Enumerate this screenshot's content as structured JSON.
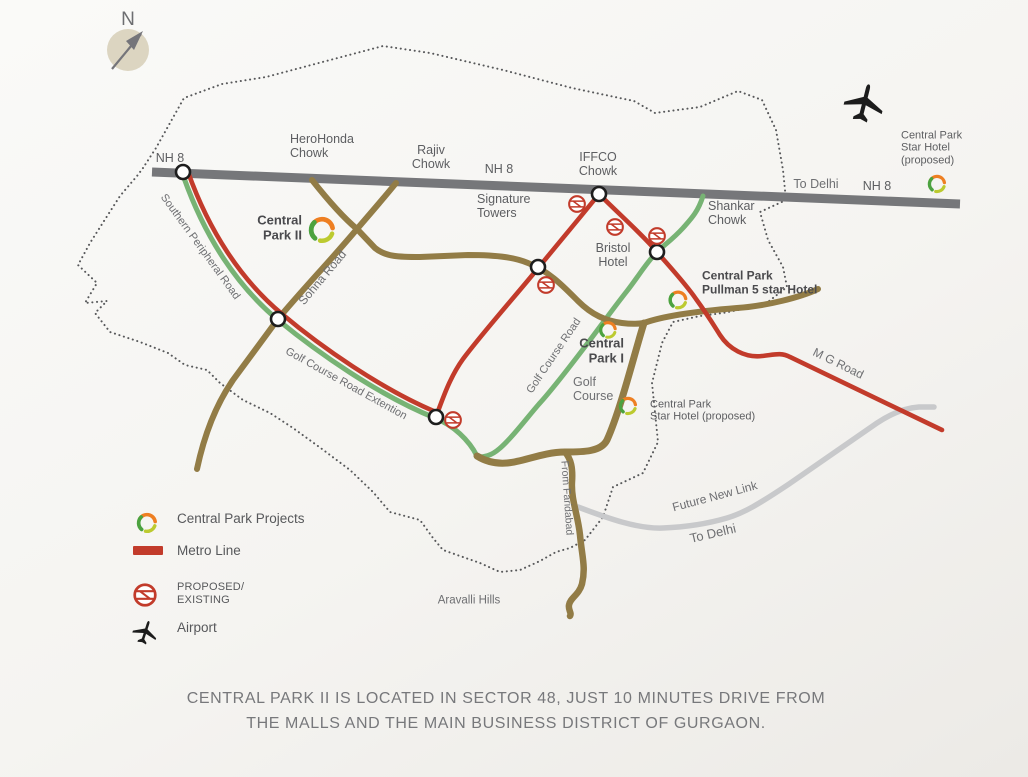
{
  "title": "Central Park II location map, Gurgaon",
  "compass": {
    "label": "N"
  },
  "colors": {
    "nh8_road": "#76777a",
    "brown_road": "#927c46",
    "green_road": "#77b374",
    "metro_red": "#c23b2b",
    "future_link_gray": "#c8c9cb",
    "boundary_dots": "#57585a",
    "label_text": "#5d5e61",
    "road_text": "#6e6f72",
    "caption_text": "#77787b",
    "logo_orange": "#ee7f22",
    "logo_green": "#4ca23f",
    "logo_lime": "#bcca2f",
    "compass_fill": "#dcd5c1"
  },
  "map": {
    "labels": [
      {
        "id": "nh8-left",
        "text": "NH 8",
        "x": 170,
        "y": 158,
        "ha": "center",
        "size": 12.5
      },
      {
        "id": "herohonda-chowk",
        "text": "HeroHonda\nChowk",
        "x": 290,
        "y": 146,
        "ha": "left",
        "size": 12.5
      },
      {
        "id": "rajiv-chowk",
        "text": "Rajiv\nChowk",
        "x": 431,
        "y": 157,
        "ha": "center",
        "size": 12.5
      },
      {
        "id": "nh8-center",
        "text": "NH 8",
        "x": 499,
        "y": 169,
        "ha": "center",
        "size": 12.5
      },
      {
        "id": "iffco-chowk",
        "text": "IFFCO\nChowk",
        "x": 598,
        "y": 164,
        "ha": "center",
        "size": 12.5
      },
      {
        "id": "signature-towers",
        "text": "Signature\nTowers",
        "x": 477,
        "y": 206,
        "ha": "left",
        "size": 12.5
      },
      {
        "id": "shankar-chowk",
        "text": "Shankar\nChowk",
        "x": 708,
        "y": 213,
        "ha": "left",
        "size": 12.5
      },
      {
        "id": "to-delhi-top",
        "text": "To Delhi",
        "x": 816,
        "y": 184,
        "ha": "center",
        "size": 12.5,
        "color": "#6e6f72"
      },
      {
        "id": "nh8-right",
        "text": "NH 8",
        "x": 877,
        "y": 186,
        "ha": "center",
        "size": 12.5
      },
      {
        "id": "cp-star-hotel-ne",
        "text": "Central Park\nStar Hotel\n(proposed)",
        "x": 901,
        "y": 148,
        "ha": "left",
        "size": 11
      },
      {
        "id": "central-park-2",
        "text": "Central\nPark II",
        "x": 302,
        "y": 228,
        "ha": "right",
        "size": 13,
        "bold": true,
        "color": "#4a4a4d"
      },
      {
        "id": "bristol-hotel",
        "text": "Bristol\nHotel",
        "x": 613,
        "y": 255,
        "ha": "center",
        "size": 12.5
      },
      {
        "id": "cp-pullman",
        "text": "Central Park\nPullman 5 star Hotel",
        "x": 702,
        "y": 283,
        "ha": "left",
        "size": 12,
        "bold": true,
        "color": "#4a4a4d"
      },
      {
        "id": "central-park-1",
        "text": "Central\nPark I",
        "x": 624,
        "y": 351,
        "ha": "right",
        "size": 13,
        "bold": true,
        "color": "#4a4a4d"
      },
      {
        "id": "golf-course",
        "text": "Golf\nCourse",
        "x": 573,
        "y": 389,
        "ha": "left",
        "size": 12.5,
        "color": "#6e6f72"
      },
      {
        "id": "cp-star-hotel-mid",
        "text": "Central Park\nStar Hotel (proposed)",
        "x": 650,
        "y": 411,
        "ha": "left",
        "size": 11
      },
      {
        "id": "aravalli-hills",
        "text": "Aravalli Hills",
        "x": 469,
        "y": 601,
        "ha": "center",
        "size": 11.5,
        "color": "#6e6f72"
      },
      {
        "id": "southern-peripheral-road",
        "text": "Southern Peripheral Road",
        "x": 200,
        "y": 247,
        "ha": "center",
        "rot": 54,
        "size": 11,
        "color": "#6e6f72"
      },
      {
        "id": "sohna-road",
        "text": "Sohna Road",
        "x": 323,
        "y": 278,
        "ha": "center",
        "rot": -50,
        "size": 12,
        "color": "#6e6f72"
      },
      {
        "id": "golf-course-road-extention",
        "text": "Golf Course Road Extention",
        "x": 346,
        "y": 384,
        "ha": "center",
        "rot": 29,
        "size": 11,
        "color": "#6e6f72"
      },
      {
        "id": "golf-course-road",
        "text": "Golf Course Road",
        "x": 554,
        "y": 356,
        "ha": "center",
        "rot": -56,
        "size": 11,
        "color": "#6e6f72"
      },
      {
        "id": "from-faridabad",
        "text": "From Faridabad",
        "x": 566,
        "y": 498,
        "ha": "center",
        "rot": 86,
        "size": 10.5,
        "color": "#6e6f72"
      },
      {
        "id": "mg-road",
        "text": "M G Road",
        "x": 838,
        "y": 364,
        "ha": "center",
        "rot": 26,
        "size": 12,
        "color": "#6e6f72"
      },
      {
        "id": "future-new-link",
        "text": "Future New Link",
        "x": 715,
        "y": 497,
        "ha": "center",
        "rot": -15,
        "size": 12,
        "color": "#6e6f72"
      },
      {
        "id": "to-delhi-se",
        "text": "To Delhi",
        "x": 713,
        "y": 534,
        "ha": "center",
        "rot": -13,
        "size": 13,
        "color": "#6e6f72"
      }
    ]
  },
  "legend": {
    "items": [
      {
        "label": "Central Park Projects"
      },
      {
        "label": "Metro Line"
      },
      {
        "label": "PROPOSED/\nEXISTING"
      },
      {
        "label": "Airport"
      }
    ]
  },
  "caption": {
    "line1": "CENTRAL PARK II IS LOCATED IN SECTOR 48, JUST 10 MINUTES DRIVE FROM",
    "line2": "THE MALLS AND THE MAIN BUSINESS DISTRICT OF GURGAON."
  }
}
